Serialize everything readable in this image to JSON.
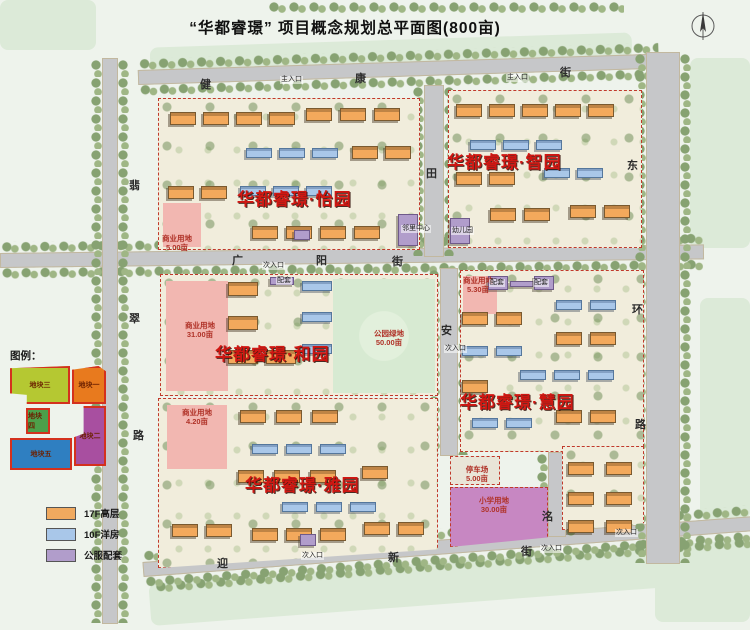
{
  "title": "“华都睿璟” 项目概念规划总平面图(800亩)",
  "districts": [
    {
      "name": "华都睿璟·怡园",
      "x": 237,
      "y": 185
    },
    {
      "name": "华都睿璟·智园",
      "x": 447,
      "y": 148
    },
    {
      "name": "华都睿璟·和园",
      "x": 215,
      "y": 340
    },
    {
      "name": "华都睿璟·慧园",
      "x": 460,
      "y": 388
    },
    {
      "name": "华都睿璟·雅园",
      "x": 245,
      "y": 471
    }
  ],
  "streets": {
    "full_names": [
      "健康街",
      "广阳街",
      "迎新街",
      "翡翠路",
      "东环路"
    ],
    "chars": [
      {
        "ch": "健",
        "x": 200,
        "y": 80
      },
      {
        "ch": "康",
        "x": 355,
        "y": 74
      },
      {
        "ch": "街",
        "x": 560,
        "y": 68
      },
      {
        "ch": "广",
        "x": 232,
        "y": 256
      },
      {
        "ch": "阳",
        "x": 316,
        "y": 256
      },
      {
        "ch": "街",
        "x": 392,
        "y": 257
      },
      {
        "ch": "迎",
        "x": 217,
        "y": 559
      },
      {
        "ch": "新",
        "x": 388,
        "y": 553
      },
      {
        "ch": "街",
        "x": 521,
        "y": 547
      },
      {
        "ch": "翡",
        "x": 129,
        "y": 181
      },
      {
        "ch": "翠",
        "x": 129,
        "y": 314
      },
      {
        "ch": "路",
        "x": 133,
        "y": 431
      },
      {
        "ch": "东",
        "x": 627,
        "y": 161
      },
      {
        "ch": "环",
        "x": 632,
        "y": 305
      },
      {
        "ch": "路",
        "x": 635,
        "y": 420
      },
      {
        "ch": "田",
        "x": 426,
        "y": 169
      },
      {
        "ch": "安",
        "x": 441,
        "y": 326
      },
      {
        "ch": "洺",
        "x": 542,
        "y": 512
      }
    ]
  },
  "parcels": [
    {
      "label": "商业用地",
      "value": "5.00亩",
      "x": 177,
      "y": 234
    },
    {
      "label": "商业用地",
      "value": "31.00亩",
      "x": 200,
      "y": 321
    },
    {
      "label": "公园绿地",
      "value": "50.00亩",
      "x": 389,
      "y": 329
    },
    {
      "label": "商业用地",
      "value": "5.30亩",
      "x": 478,
      "y": 276
    },
    {
      "label": "商业用地",
      "value": "4.20亩",
      "x": 197,
      "y": 408
    },
    {
      "label": "停车场",
      "value": "5.00亩",
      "x": 477,
      "y": 465
    },
    {
      "label": "小学用地",
      "value": "30.00亩",
      "x": 494,
      "y": 496
    }
  ],
  "markers": [
    {
      "text": "主入口",
      "x": 280,
      "y": 76
    },
    {
      "text": "主入口",
      "x": 506,
      "y": 74
    },
    {
      "text": "次入口",
      "x": 262,
      "y": 262
    },
    {
      "text": "次入口",
      "x": 444,
      "y": 345
    },
    {
      "text": "次入口",
      "x": 301,
      "y": 552
    },
    {
      "text": "次入口",
      "x": 540,
      "y": 545
    },
    {
      "text": "次入口",
      "x": 615,
      "y": 529
    },
    {
      "text": "配套",
      "x": 276,
      "y": 277
    },
    {
      "text": "配套",
      "x": 489,
      "y": 279
    },
    {
      "text": "配套",
      "x": 533,
      "y": 279
    },
    {
      "text": "邻里中心",
      "x": 401,
      "y": 225
    },
    {
      "text": "幼儿园",
      "x": 451,
      "y": 227
    }
  ],
  "legend_key": {
    "heading": "图例：",
    "parcels": [
      {
        "label": "地块三",
        "color": "#b5c832"
      },
      {
        "label": "地块一",
        "color": "#e87a1e"
      },
      {
        "label": "地块四",
        "color": "#4ca04a"
      },
      {
        "label": "地块二",
        "color": "#a84fa0"
      },
      {
        "label": "地块五",
        "color": "#2f7fc1"
      }
    ]
  },
  "type_legend": [
    {
      "label": "17F高层",
      "color": "#f0a95f"
    },
    {
      "label": "10F洋房",
      "color": "#a9c7e9"
    },
    {
      "label": "公服配套",
      "color": "#b19dcb"
    }
  ],
  "colors": {
    "district_label": "#d01712",
    "parcel_label": "#b03228",
    "block_border": "#c0392b",
    "road": "#c6c7c9",
    "park": "#d7ead2",
    "school_parcel": "#c787c2",
    "commercial_parcel": "#f2b7b1"
  }
}
